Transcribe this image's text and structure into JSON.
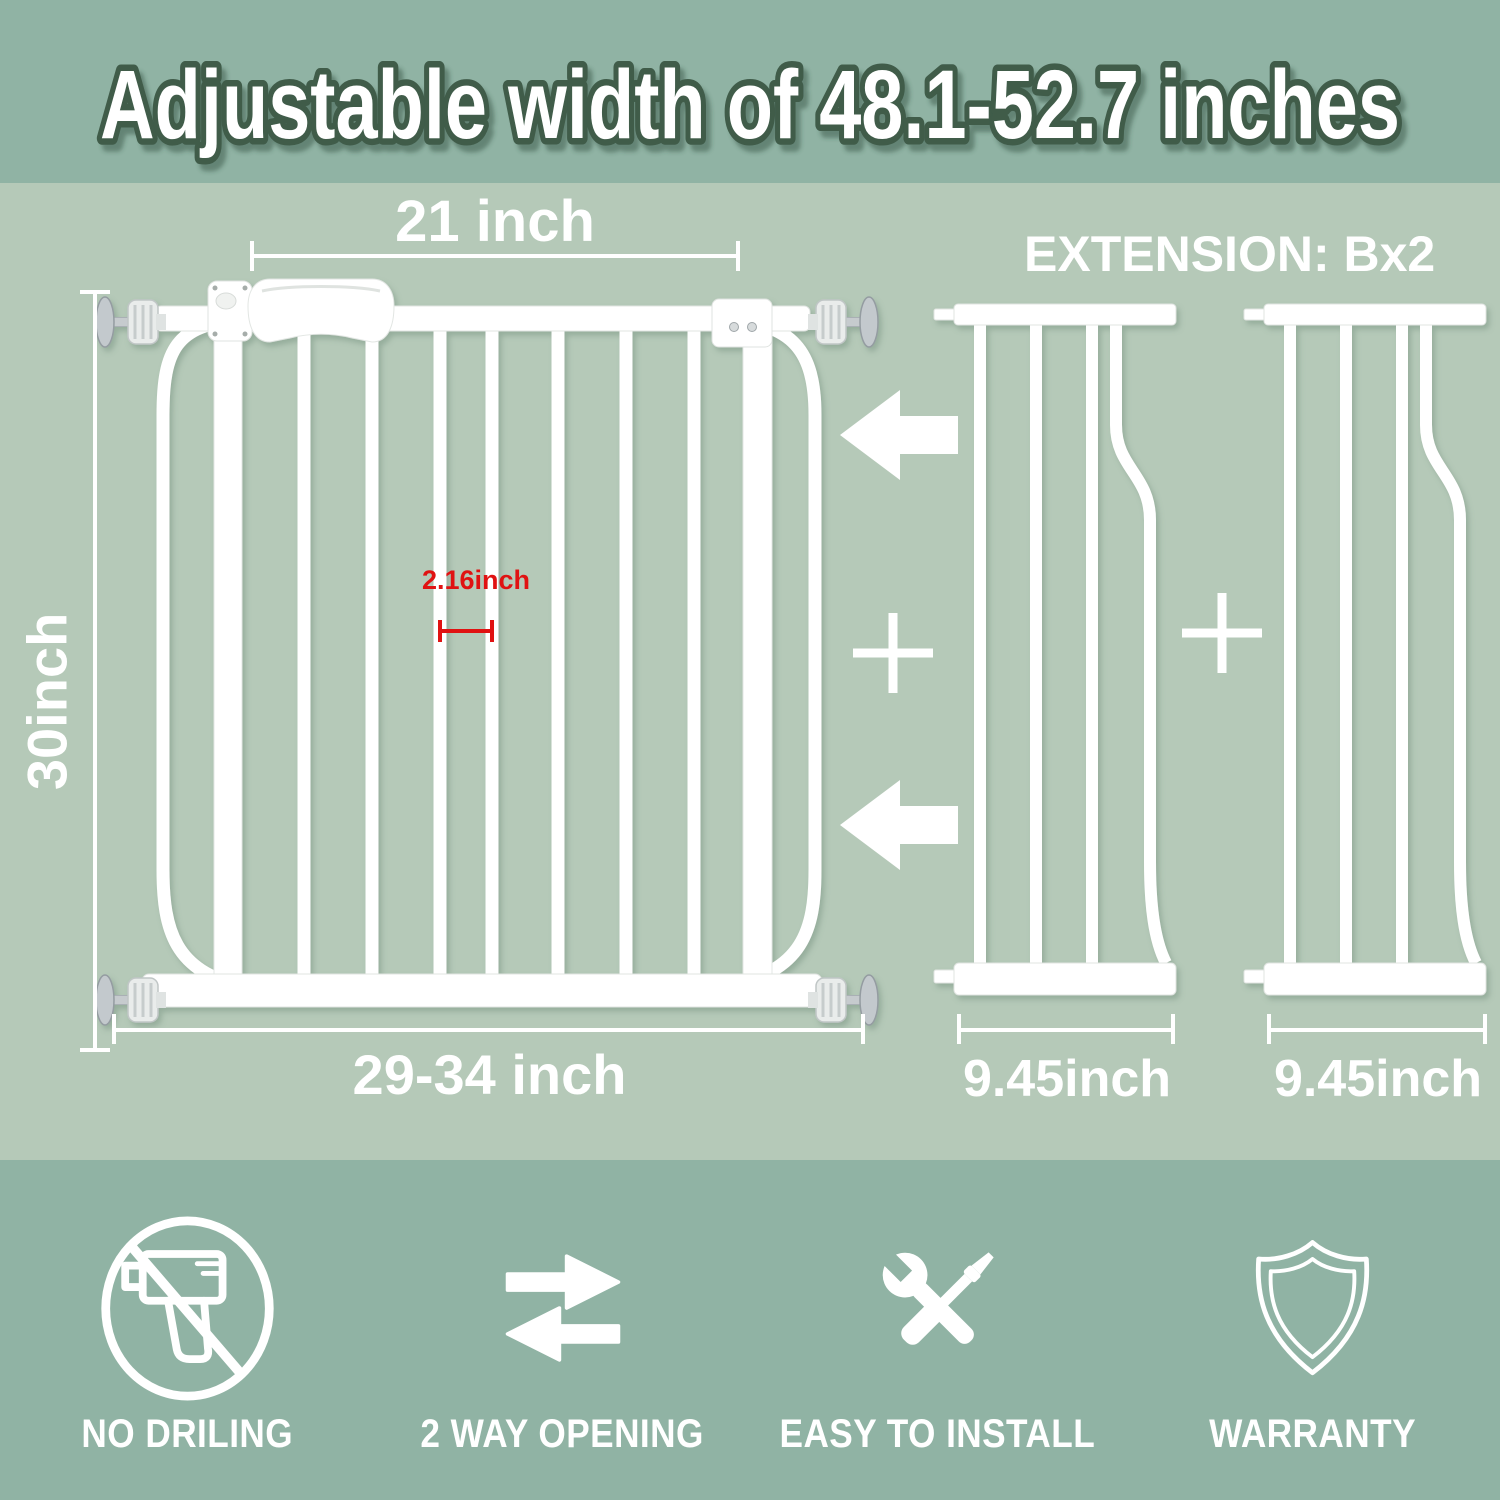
{
  "title": "Adjustable width of 48.1-52.7 inches",
  "colors": {
    "band_green": "#90b3a4",
    "panel_green": "#b5c9b8",
    "title_fill": "#ffffff",
    "title_outline": "#3f5b4a",
    "dimension_text": "#ffffff",
    "gap_red": "#e01212",
    "gate_white": "#ffffff"
  },
  "diagram": {
    "extension_label": "EXTENSION: Bx2",
    "gate": {
      "top_width": "21 inch",
      "height": "30inch",
      "bottom_width": "29-34 inch",
      "bar_gap": "2.16inch"
    },
    "extensions": {
      "a_width": "9.45inch",
      "b_width": "9.45inch"
    }
  },
  "features": [
    {
      "label": "NO DRILING",
      "icon": "no-drilling-icon"
    },
    {
      "label": "2 WAY OPENING",
      "icon": "two-way-opening-icon"
    },
    {
      "label": "EASY TO INSTALL",
      "icon": "easy-to-install-icon"
    },
    {
      "label": "WARRANTY",
      "icon": "warranty-icon"
    }
  ]
}
